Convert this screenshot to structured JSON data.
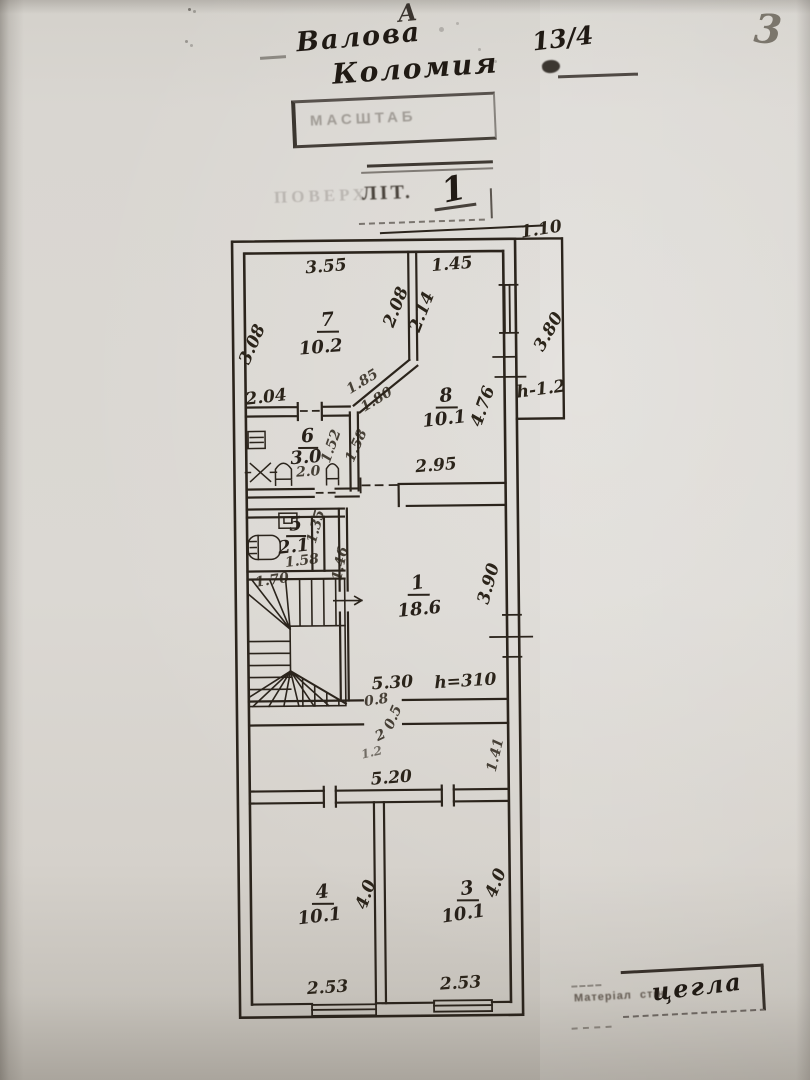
{
  "page": {
    "number": "3",
    "annotation_a": "A"
  },
  "header": {
    "street": "Валова",
    "city": "Коломия",
    "house_number": "13/4"
  },
  "stamps": {
    "scale_label": "МАСШТАБ",
    "floor_prefix": "ПОВЕРХ",
    "floor_label": "ЛІТ.",
    "floor_value": "1"
  },
  "footer": {
    "material_label_1": "Матеріал",
    "material_label_2": "стін",
    "material_value": "цегла"
  },
  "plan": {
    "rooms": {
      "r7": {
        "number": "7",
        "area": "10.2"
      },
      "r8": {
        "number": "8",
        "area": "10.1"
      },
      "r6": {
        "number": "6",
        "area": "3.0"
      },
      "r5": {
        "number": "5",
        "area": "2.1"
      },
      "r1": {
        "number": "1",
        "area": "18.6"
      },
      "r4": {
        "number": "4",
        "area": "10.1"
      },
      "r3": {
        "number": "3",
        "area": "10.1"
      }
    },
    "dims": {
      "top_offset": "1.10",
      "room7_top": "3.55",
      "topright_width": "1.45",
      "wall_208": "2.08",
      "wall_214": "2.14",
      "room7_left": "3.08",
      "bay_height": "3.80",
      "wall_204": "2.04",
      "diag_a": "1.85",
      "diag_b": "1.80",
      "room8_right": "4.76",
      "bay_h": "h-1.2",
      "room6_right": "1.52",
      "corridor_158": "1.58",
      "room6_bottom": "2.0",
      "room8_bottom": "2.95",
      "nook_135": "1.35",
      "room5_bottom": "1.58",
      "shaft_146": "1.46",
      "room1_right": "3.90",
      "stairs_top": "1.70",
      "hall_width": "5.30",
      "ceiling_h": "h=310",
      "door_08": "0.8",
      "door_05": "0.5",
      "mark_2": "2",
      "mark_12": "1.2",
      "hall_right": "1.41",
      "bottom_top": "5.20",
      "room4_right": "4.0",
      "room3_right": "4.0",
      "room4_window": "2.53",
      "room3_window": "2.53"
    }
  }
}
